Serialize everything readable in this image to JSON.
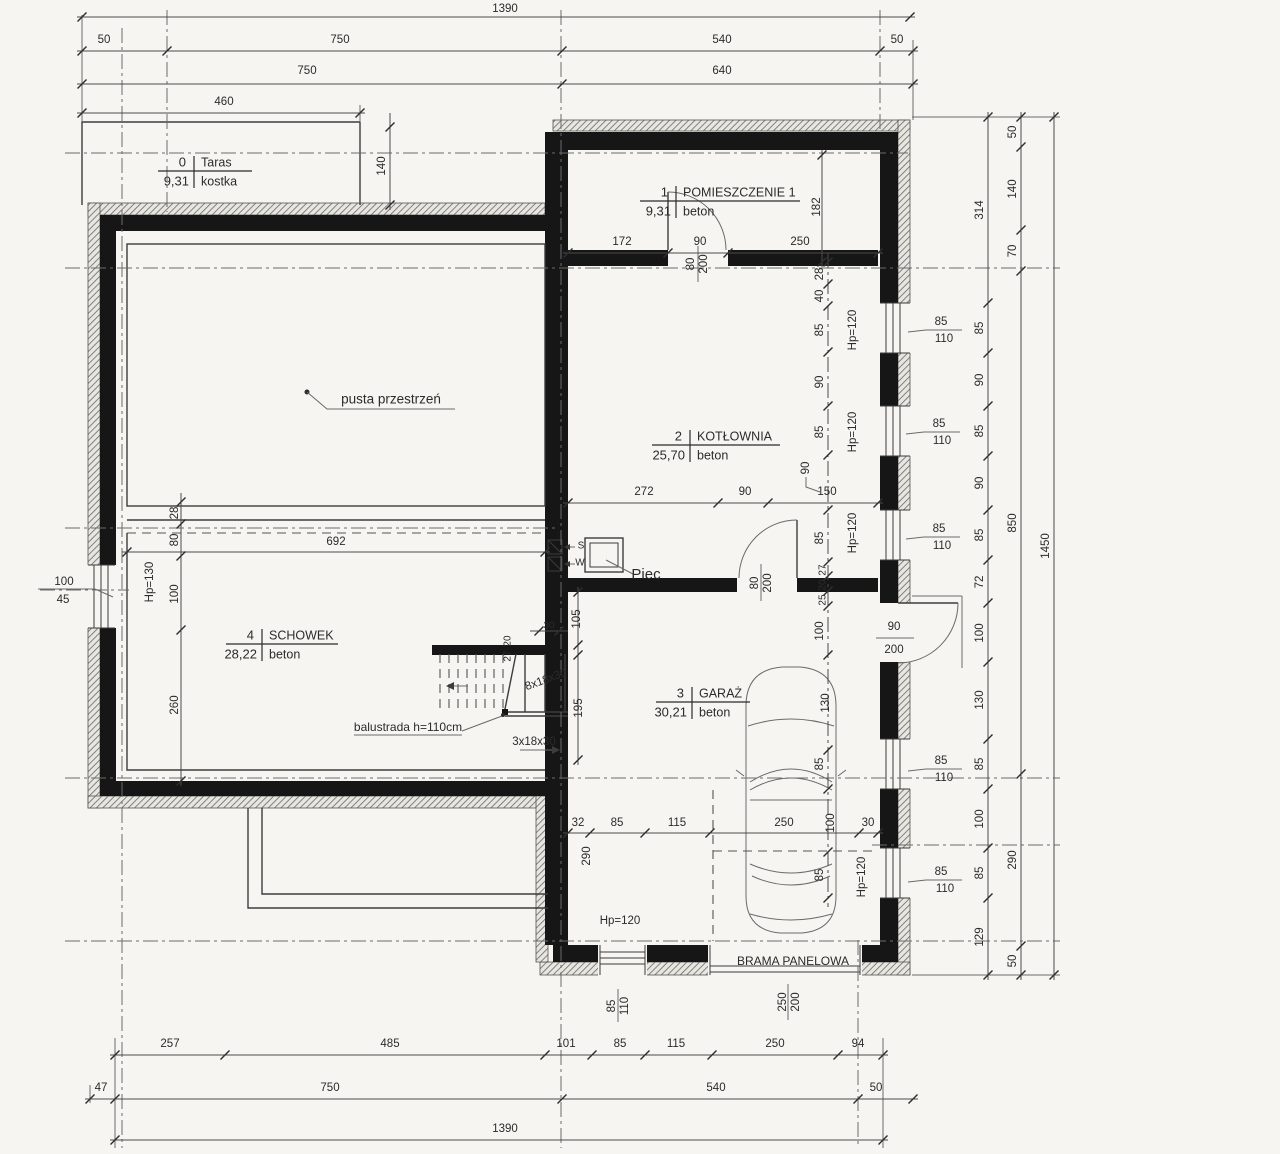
{
  "colors": {
    "paper": "#f6f5f1",
    "wall": "#161616",
    "line": "#3c3c3c",
    "dim": "#2b2b2b",
    "gray_note": "#979797"
  },
  "legend": {
    "drawing_type": "floor-plan",
    "stair_notes": [
      "8x18x30",
      "3x18x30"
    ],
    "garage_door_label": "BRAMA PANELOWA"
  },
  "rooms": [
    {
      "no": "0",
      "name": "Taras",
      "area": "9,31",
      "mat": "kostka",
      "cx": 194,
      "cy": 171,
      "lx": 158,
      "rx": 252
    },
    {
      "no": "1",
      "name": "POMIESZCZENIE 1",
      "area": "9,31",
      "mat": "beton",
      "cx": 676,
      "cy": 201,
      "lx": 640,
      "rx": 800
    },
    {
      "no": "2",
      "name": "KOTŁOWNIA",
      "area": "25,70",
      "mat": "beton",
      "cx": 690,
      "cy": 445,
      "lx": 652,
      "rx": 780
    },
    {
      "no": "3",
      "name": "GARAŻ",
      "area": "30,21",
      "mat": "beton",
      "cx": 692,
      "cy": 702,
      "lx": 656,
      "rx": 750
    },
    {
      "no": "4",
      "name": "SCHOWEK",
      "area": "28,22",
      "mat": "beton",
      "cx": 262,
      "cy": 644,
      "lx": 226,
      "rx": 338
    }
  ],
  "labels": [
    {
      "t": "1390",
      "x": 505,
      "y": 9
    },
    {
      "t": "50",
      "x": 104,
      "y": 40
    },
    {
      "t": "750",
      "x": 340,
      "y": 40
    },
    {
      "t": "540",
      "x": 722,
      "y": 40
    },
    {
      "t": "50",
      "x": 897,
      "y": 40
    },
    {
      "t": "750",
      "x": 307,
      "y": 71
    },
    {
      "t": "640",
      "x": 722,
      "y": 71
    },
    {
      "t": "460",
      "x": 224,
      "y": 102
    },
    {
      "t": "140",
      "x": 382,
      "y": 166,
      "r": -90
    },
    {
      "t": "314",
      "x": 980,
      "y": 210,
      "r": -90
    },
    {
      "t": "85",
      "x": 980,
      "y": 328,
      "r": -90
    },
    {
      "t": "90",
      "x": 980,
      "y": 380,
      "r": -90
    },
    {
      "t": "85",
      "x": 980,
      "y": 431,
      "r": -90
    },
    {
      "t": "90",
      "x": 980,
      "y": 483,
      "r": -90
    },
    {
      "t": "85",
      "x": 980,
      "y": 535,
      "r": -90
    },
    {
      "t": "72",
      "x": 980,
      "y": 582,
      "r": -90
    },
    {
      "t": "100",
      "x": 980,
      "y": 633,
      "r": -90
    },
    {
      "t": "130",
      "x": 980,
      "y": 700,
      "r": -90
    },
    {
      "t": "85",
      "x": 980,
      "y": 764,
      "r": -90
    },
    {
      "t": "100",
      "x": 980,
      "y": 819,
      "r": -90
    },
    {
      "t": "85",
      "x": 980,
      "y": 873,
      "r": -90
    },
    {
      "t": "129",
      "x": 980,
      "y": 937,
      "r": -90
    },
    {
      "t": "50",
      "x": 1013,
      "y": 132,
      "r": -90
    },
    {
      "t": "140",
      "x": 1013,
      "y": 189,
      "r": -90
    },
    {
      "t": "70",
      "x": 1013,
      "y": 251,
      "r": -90
    },
    {
      "t": "850",
      "x": 1013,
      "y": 523,
      "r": -90
    },
    {
      "t": "290",
      "x": 1013,
      "y": 860,
      "r": -90
    },
    {
      "t": "50",
      "x": 1013,
      "y": 961,
      "r": -90
    },
    {
      "t": "1450",
      "x": 1046,
      "y": 546,
      "r": -90
    },
    {
      "t": "85",
      "x": 941,
      "y": 322
    },
    {
      "t": "110",
      "x": 944,
      "y": 339
    },
    {
      "t": "85",
      "x": 939,
      "y": 424
    },
    {
      "t": "110",
      "x": 942,
      "y": 441
    },
    {
      "t": "85",
      "x": 939,
      "y": 529
    },
    {
      "t": "110",
      "x": 942,
      "y": 546
    },
    {
      "t": "85",
      "x": 941,
      "y": 761
    },
    {
      "t": "110",
      "x": 944,
      "y": 778
    },
    {
      "t": "85",
      "x": 941,
      "y": 872
    },
    {
      "t": "110",
      "x": 945,
      "y": 889
    },
    {
      "t": "Hp=120",
      "x": 853,
      "y": 330,
      "r": -90
    },
    {
      "t": "Hp=120",
      "x": 853,
      "y": 432,
      "r": -90
    },
    {
      "t": "Hp=120",
      "x": 853,
      "y": 533,
      "r": -90
    },
    {
      "t": "Hp=120",
      "x": 862,
      "y": 877,
      "r": -90
    },
    {
      "t": "Hp=120",
      "x": 620,
      "y": 921
    },
    {
      "t": "Hp=130",
      "x": 150,
      "y": 582,
      "r": -90
    },
    {
      "t": "172",
      "x": 622,
      "y": 242
    },
    {
      "t": "90",
      "x": 700,
      "y": 242
    },
    {
      "t": "250",
      "x": 800,
      "y": 242
    },
    {
      "t": "182",
      "x": 817,
      "y": 207,
      "r": -90
    },
    {
      "t": "28",
      "x": 820,
      "y": 274,
      "r": -90
    },
    {
      "t": "40",
      "x": 820,
      "y": 296,
      "r": -90
    },
    {
      "t": "80",
      "x": 691,
      "y": 264,
      "r": -90
    },
    {
      "t": "200",
      "x": 704,
      "y": 264,
      "r": -90
    },
    {
      "t": "85",
      "x": 820,
      "y": 330,
      "r": -90
    },
    {
      "t": "90",
      "x": 820,
      "y": 382,
      "r": -90
    },
    {
      "t": "85",
      "x": 820,
      "y": 432,
      "r": -90
    },
    {
      "t": "90",
      "x": 806,
      "y": 468,
      "r": -90
    },
    {
      "t": "85",
      "x": 820,
      "y": 538,
      "r": -90
    },
    {
      "t": "27",
      "x": 823,
      "y": 570,
      "r": -90,
      "s": 10
    },
    {
      "t": "20",
      "x": 823,
      "y": 585,
      "r": -90,
      "s": 10
    },
    {
      "t": "25",
      "x": 823,
      "y": 600,
      "r": -90,
      "s": 10
    },
    {
      "t": "100",
      "x": 820,
      "y": 631,
      "r": -90
    },
    {
      "t": "130",
      "x": 826,
      "y": 703,
      "r": -90
    },
    {
      "t": "85",
      "x": 820,
      "y": 764,
      "r": -90
    },
    {
      "t": "100",
      "x": 831,
      "y": 823,
      "r": -90
    },
    {
      "t": "85",
      "x": 820,
      "y": 875,
      "r": -90
    },
    {
      "t": "272",
      "x": 644,
      "y": 492
    },
    {
      "t": "90",
      "x": 745,
      "y": 492
    },
    {
      "t": "150",
      "x": 827,
      "y": 492
    },
    {
      "t": "80",
      "x": 755,
      "y": 583,
      "r": -90
    },
    {
      "t": "200",
      "x": 768,
      "y": 583,
      "r": -90
    },
    {
      "t": "90",
      "x": 894,
      "y": 627
    },
    {
      "t": "200",
      "x": 894,
      "y": 650
    },
    {
      "t": "32",
      "x": 578,
      "y": 823
    },
    {
      "t": "85",
      "x": 617,
      "y": 823
    },
    {
      "t": "115",
      "x": 677,
      "y": 823
    },
    {
      "t": "250",
      "x": 784,
      "y": 823
    },
    {
      "t": "30",
      "x": 868,
      "y": 823
    },
    {
      "t": "290",
      "x": 587,
      "y": 856,
      "r": -90
    },
    {
      "t": "105",
      "x": 577,
      "y": 619,
      "r": -90
    },
    {
      "t": "195",
      "x": 579,
      "y": 708,
      "r": -90
    },
    {
      "t": "30",
      "x": 549,
      "y": 626,
      "s": 10
    },
    {
      "t": "20",
      "x": 508,
      "y": 641,
      "r": -90,
      "s": 10
    },
    {
      "t": "27",
      "x": 508,
      "y": 656,
      "r": -90,
      "s": 10
    },
    {
      "t": "8x18x30",
      "x": 546,
      "y": 680,
      "r": -20,
      "c": "#979797"
    },
    {
      "t": "3x18x30",
      "x": 534,
      "y": 742
    },
    {
      "t": "balustrada h=110cm",
      "x": 408,
      "y": 728,
      "s": 12
    },
    {
      "t": "pusta przestrzeń",
      "x": 391,
      "y": 400,
      "s": 13.5
    },
    {
      "t": "692",
      "x": 336,
      "y": 542
    },
    {
      "t": "28",
      "x": 175,
      "y": 513,
      "r": -90
    },
    {
      "t": "80",
      "x": 175,
      "y": 540,
      "r": -90
    },
    {
      "t": "100",
      "x": 175,
      "y": 594,
      "r": -90
    },
    {
      "t": "260",
      "x": 175,
      "y": 705,
      "r": -90
    },
    {
      "t": "100",
      "x": 64,
      "y": 582
    },
    {
      "t": "45",
      "x": 63,
      "y": 600
    },
    {
      "t": "Piec",
      "x": 646,
      "y": 575,
      "s": 15
    },
    {
      "t": "S",
      "x": 581,
      "y": 546,
      "s": 10
    },
    {
      "t": "W",
      "x": 580,
      "y": 563,
      "s": 10
    },
    {
      "t": "BRAMA PANELOWA",
      "x": 793,
      "y": 962,
      "s": 12
    },
    {
      "t": "250",
      "x": 783,
      "y": 1002,
      "r": -90
    },
    {
      "t": "200",
      "x": 796,
      "y": 1002,
      "r": -90
    },
    {
      "t": "85",
      "x": 612,
      "y": 1006,
      "r": -90
    },
    {
      "t": "110",
      "x": 625,
      "y": 1006,
      "r": -90
    },
    {
      "t": "257",
      "x": 170,
      "y": 1044
    },
    {
      "t": "485",
      "x": 390,
      "y": 1044
    },
    {
      "t": "101",
      "x": 566,
      "y": 1044
    },
    {
      "t": "85",
      "x": 620,
      "y": 1044
    },
    {
      "t": "115",
      "x": 676,
      "y": 1044
    },
    {
      "t": "250",
      "x": 775,
      "y": 1044
    },
    {
      "t": "94",
      "x": 858,
      "y": 1044
    },
    {
      "t": "47",
      "x": 101,
      "y": 1088
    },
    {
      "t": "750",
      "x": 330,
      "y": 1088
    },
    {
      "t": "540",
      "x": 716,
      "y": 1088
    },
    {
      "t": "50",
      "x": 876,
      "y": 1088
    },
    {
      "t": "1390",
      "x": 505,
      "y": 1129
    }
  ],
  "geometry": {
    "axes_h": [
      [
        65,
        908,
        153
      ],
      [
        65,
        1060,
        268
      ],
      [
        65,
        556,
        528
      ],
      [
        40,
        129,
        590
      ],
      [
        65,
        1060,
        778
      ],
      [
        872,
        1060,
        845
      ],
      [
        65,
        1060,
        941
      ]
    ],
    "axes_v": [
      [
        28,
        1148,
        122
      ],
      [
        10,
        212,
        167
      ],
      [
        10,
        1148,
        561
      ],
      [
        10,
        130,
        880
      ],
      [
        940,
        1148,
        858
      ]
    ],
    "dim_h": [
      {
        "y": 17,
        "a": 82,
        "b": 910,
        "ticks": [
          82,
          910
        ]
      },
      {
        "y": 51,
        "a": 82,
        "b": 913,
        "ticks": [
          82,
          167,
          562,
          880,
          913
        ]
      },
      {
        "y": 84,
        "a": 82,
        "b": 913,
        "ticks": [
          82,
          562,
          913
        ]
      },
      {
        "y": 113,
        "a": 82,
        "b": 360,
        "ticks": [
          82,
          360
        ]
      },
      {
        "y": 253,
        "a": 568,
        "b": 878,
        "ticks": [
          568,
          668,
          728,
          878
        ]
      },
      {
        "y": 503,
        "a": 568,
        "b": 878,
        "ticks": [
          568,
          718,
          768,
          878
        ]
      },
      {
        "y": 552,
        "a": 127,
        "b": 545,
        "ticks": [
          127,
          545
        ]
      },
      {
        "y": 631,
        "a": 535,
        "b": 563,
        "ticks": [
          539,
          559
        ]
      },
      {
        "y": 833,
        "a": 568,
        "b": 878,
        "ticks": [
          568,
          590,
          645,
          710,
          859,
          878
        ]
      },
      {
        "y": 1055,
        "a": 115,
        "b": 883,
        "ticks": [
          115,
          225,
          545,
          592,
          645,
          712,
          838,
          883
        ]
      },
      {
        "y": 1099,
        "a": 90,
        "b": 913,
        "ticks": [
          90,
          115,
          562,
          858,
          913
        ]
      },
      {
        "y": 1140,
        "a": 115,
        "b": 883,
        "ticks": [
          115,
          883
        ]
      }
    ],
    "dim_v": [
      {
        "x": 390,
        "a": 118,
        "b": 205,
        "ticks": [
          127,
          205
        ]
      },
      {
        "x": 822,
        "a": 155,
        "b": 262,
        "ticks": [
          155,
          262
        ]
      },
      {
        "x": 828,
        "a": 258,
        "b": 902,
        "dash": true,
        "ticks": [
          262,
          284,
          306,
          352,
          406,
          455,
          510,
          562,
          576,
          591,
          606,
          655,
          750,
          789,
          852,
          898
        ]
      },
      {
        "x": 181,
        "a": 498,
        "b": 781,
        "ticks": [
          502,
          524,
          556,
          630,
          781
        ]
      },
      {
        "x": 578,
        "a": 592,
        "b": 760,
        "ticks": [
          592,
          645,
          655,
          760
        ]
      },
      {
        "x": 988,
        "a": 117,
        "b": 975,
        "ticks": [
          117,
          303,
          353,
          406,
          456,
          510,
          560,
          603,
          662,
          739,
          789,
          848,
          898,
          975
        ]
      },
      {
        "x": 1021,
        "a": 117,
        "b": 975,
        "ticks": [
          117,
          147,
          230,
          271,
          774,
          946,
          975
        ]
      },
      {
        "x": 1054,
        "a": 117,
        "b": 975,
        "ticks": [
          117,
          975
        ]
      }
    ]
  }
}
